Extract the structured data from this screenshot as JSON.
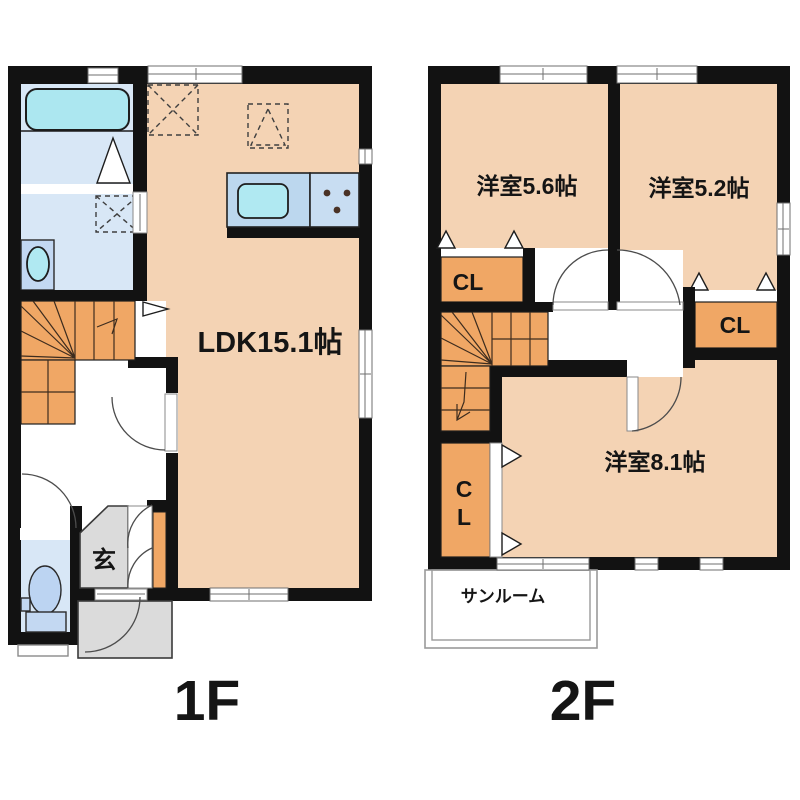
{
  "page": {
    "background": "#ffffff"
  },
  "palette": {
    "wall": "#121212",
    "room_peach": "#F4D3B4",
    "wet_room_blue": "#D8E7F6",
    "bathtub_cyan": "#ACE7F0",
    "kitchen_counter_blue": "#BCD7EE",
    "stove_blue": "#C8DDF2",
    "fixture_blue": "#C3D8F2",
    "stair_closet_orange": "#F0A765",
    "entry_gray": "#DBDBDB",
    "text": "#151515"
  },
  "floor1": {
    "label": "1F",
    "ldk_label": "LDK15.1帖",
    "entrance_label": "玄"
  },
  "floor2": {
    "label": "2F",
    "bedroom1_label": "洋室5.6帖",
    "bedroom2_label": "洋室5.2帖",
    "bedroom3_label": "洋室8.1帖",
    "closet1_label": "CL",
    "closet2_label": "CL",
    "closet3_line1": "C",
    "closet3_line2": "L",
    "sunroom_label": "サンルーム"
  }
}
